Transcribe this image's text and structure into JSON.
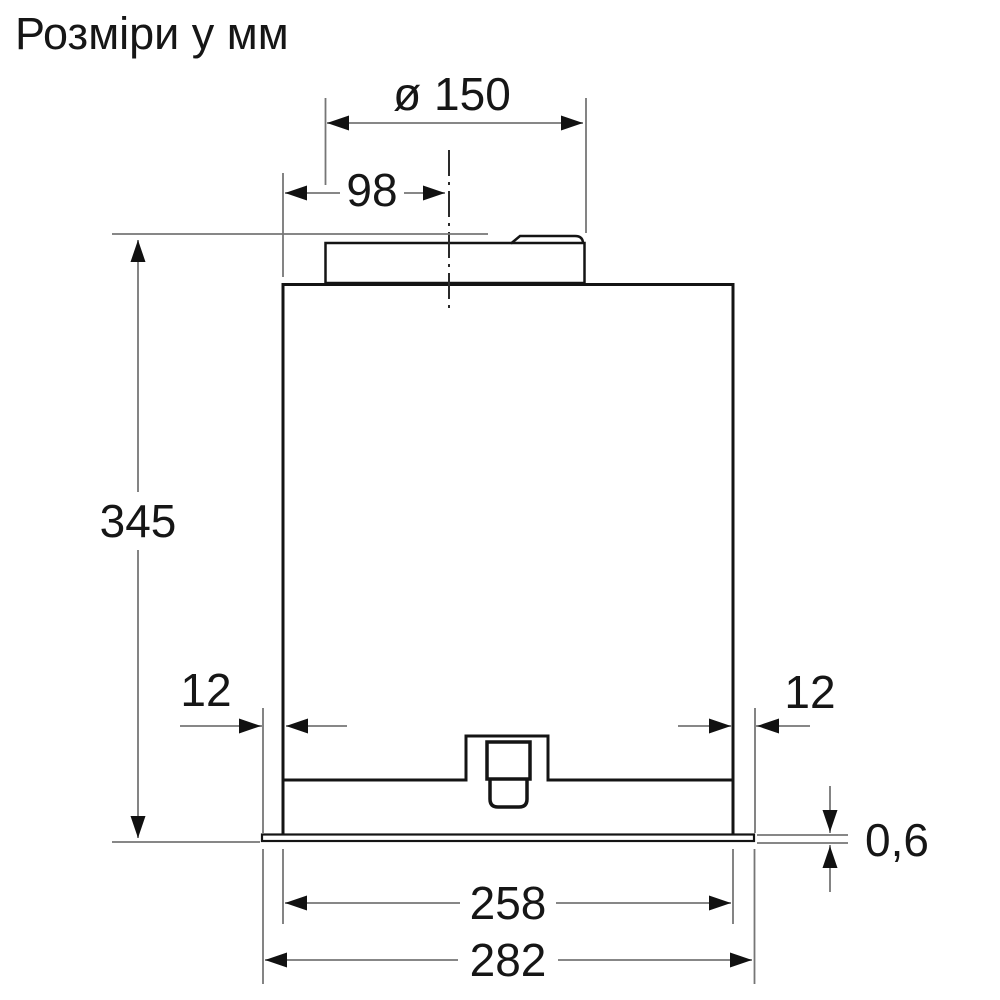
{
  "title": "Розміри у мм",
  "drawing": {
    "description_labels": {
      "diameter": "ø 150",
      "duct_offset": "98",
      "height": "345",
      "inset_left": "12",
      "inset_right": "12",
      "panel_thickness": "0,6",
      "body_width": "258",
      "plate_width": "282"
    }
  },
  "colors": {
    "background": "#ffffff",
    "drawing_line": "#141414",
    "dimension_line": "#767676",
    "text": "#161616"
  }
}
